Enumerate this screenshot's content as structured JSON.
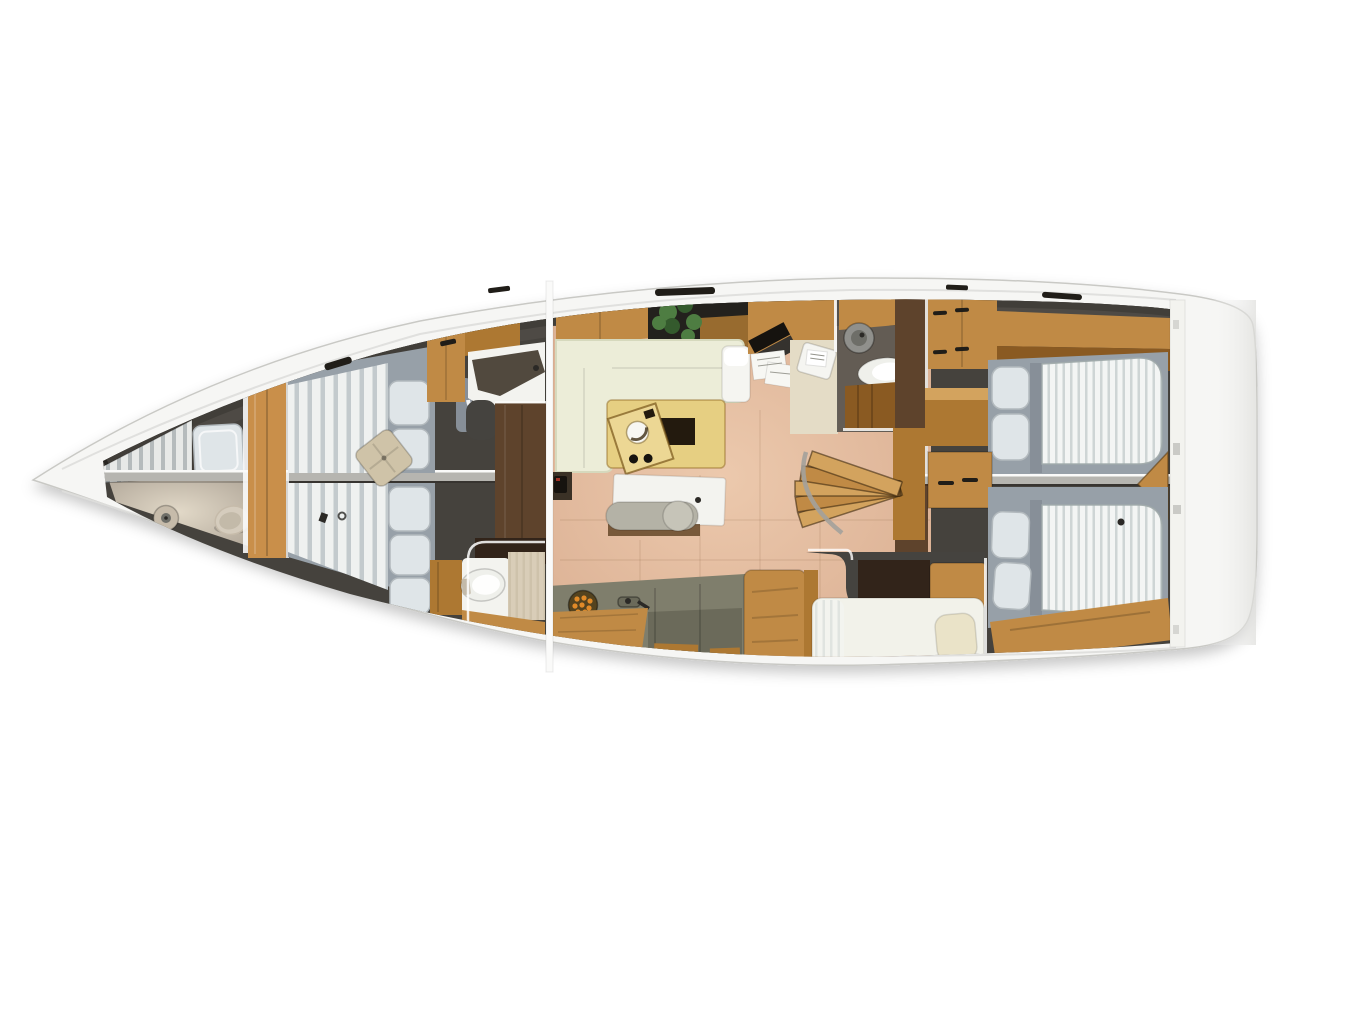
{
  "meta": {
    "description": "Top-down 3D rendered interior floor plan of a sailing yacht, bow pointing left, stern right",
    "view": "deck plan from above",
    "orientation": "bow-left"
  },
  "rooms": [
    {
      "id": "forepeak",
      "name": "forepeak-crew-cabin"
    },
    {
      "id": "owner-cabin",
      "name": "forward-v-berth-cabin"
    },
    {
      "id": "head-fwd-upper",
      "name": "forward-head-upper"
    },
    {
      "id": "head-fwd-lower",
      "name": "forward-head-lower"
    },
    {
      "id": "salon",
      "name": "main-salon"
    },
    {
      "id": "galley",
      "name": "galley"
    },
    {
      "id": "nav",
      "name": "navigation-station"
    },
    {
      "id": "head-aft",
      "name": "aft-head"
    },
    {
      "id": "companionway",
      "name": "companionway-stairs"
    },
    {
      "id": "aft-cabin-upper",
      "name": "aft-double-cabin-upper"
    },
    {
      "id": "aft-cabin-lower",
      "name": "aft-double-cabin-lower"
    },
    {
      "id": "berth-nook",
      "name": "single-berth-nook"
    }
  ],
  "palette": {
    "pageBg": "#ffffff",
    "hull": "#f6f6f4",
    "hullEdge": "#c9c9c5",
    "deckSeam": "#dededb",
    "interior": "#45423d",
    "interiorRim": "#23211d",
    "wallGray": "#55524d",
    "divider": "#b6b5b0",
    "white": "#fafaf9",
    "wood": "#c08a45",
    "woodLight": "#d3a35e",
    "woodMid": "#ad7832",
    "woodDark": "#8a5a22",
    "woodDeep": "#5c4020",
    "bulkheadWood": "#c98f4a",
    "floorSalon": "#d9ad90",
    "floorSalonLight": "#ecc9ad",
    "floorFore": "#b2a89a",
    "floorForeLight": "#e2d9c8",
    "corridorBrown": "#5e432c",
    "counterOlive": "#7f7e6c",
    "counterOliveDark": "#6b6a5a",
    "sofaCream": "#ecedd8",
    "sofaEdge": "#d6d9bd",
    "chaiseWhite": "#f5f5f1",
    "tableBirch": "#e6cf82",
    "tableInsert": "#231a0e",
    "trayWood": "#ecd794",
    "credenzaWhite": "#f3f3ef",
    "benchGray": "#b4b2a6",
    "benchPad": "#c6c4b8",
    "mattressGray": "#97a0a8",
    "mattressDark": "#878f98",
    "stripeLight": "#eff1f0",
    "stripeDark": "#c3cacd",
    "stripeLightAft": "#f3f5f4",
    "stripeDarkAft": "#ced5d5",
    "foreStripeLight": "#e7e9e7",
    "foreStripeDark": "#b5bbbc",
    "pillowWhite": "#dfe5e8",
    "pillowEdge": "#b2b9bd",
    "berthWhite": "#f2f2ea",
    "pillowCream": "#eae3c8",
    "cushionBeige": "#cfc3a8",
    "beigePanel": "#d9cdb8",
    "beigePanelDark": "#cec2ab",
    "plantGreen": "#4e7d42",
    "plantGreenDark": "#345a2d",
    "potDark": "#23201c",
    "burnerBase": "#54431f",
    "burnerOrange": "#e08a28",
    "toiletWhite": "#eff0eb",
    "toiletBeige": "#d5ccbd",
    "toiletBeigeInner": "#c3baa9",
    "sinkBeige": "#c6bbaa",
    "sinkDisc": "#90908c",
    "sinkDiscInner": "#6e6e68",
    "fixtureDark": "#2b2926",
    "navFloor": "#e4dcc6",
    "laptopDark": "#16130f",
    "paperWhite": "#f7f7f3",
    "hatchDark": "#201d18",
    "darkBand": "#32241a",
    "headCounterDark": "#3a3126",
    "showerGray": "#45433f"
  }
}
